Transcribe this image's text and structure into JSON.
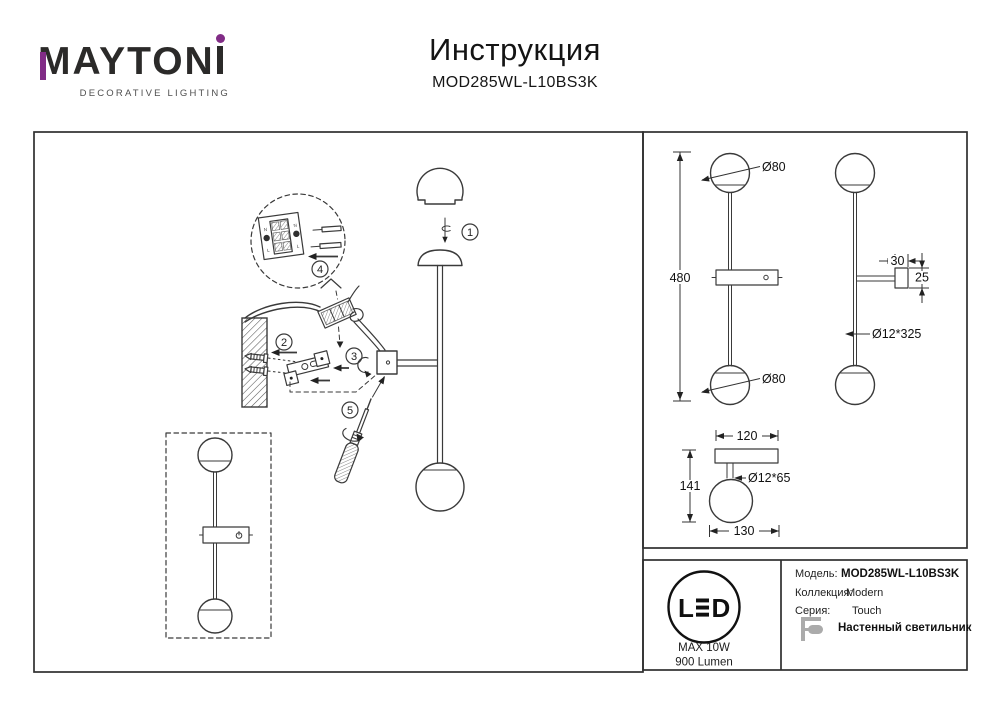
{
  "colors": {
    "accent_purple": "#812C86",
    "line": "#3A3A3A",
    "icon_gray": "#ABABAB",
    "text": "#111111"
  },
  "logo": {
    "brand_full": "MAYTONI",
    "brand_prefix": "MAYTON",
    "tagline": "DECORATIVE LIGHTING"
  },
  "header": {
    "title": "Инструкция",
    "model": "MOD285WL-L10BS3K"
  },
  "assembly": {
    "steps": [
      "1",
      "2",
      "3",
      "4",
      "5"
    ],
    "terminal": {
      "n": "N",
      "l": "L"
    }
  },
  "dimensions": {
    "front_height": "480",
    "sphere_top": "Ø80",
    "sphere_bottom": "Ø80",
    "box_width": "30",
    "box_depth": "25",
    "rod": "Ø12*325",
    "plate_width": "120",
    "stem": "Ø12*65",
    "depth": "141",
    "base_depth": "130"
  },
  "spec": {
    "led_letter_l": "L",
    "led_letter_d": "D",
    "max_power": "MAX 10W",
    "luminous_flux": "900 Lumen"
  },
  "info": {
    "rows": [
      {
        "label": "Модель:",
        "value": "MOD285WL-L10BS3K"
      },
      {
        "label": "Коллекция:",
        "value": "Modern"
      },
      {
        "label": "Серия:",
        "value": "Touch"
      }
    ],
    "type": "Настенный светильник"
  }
}
